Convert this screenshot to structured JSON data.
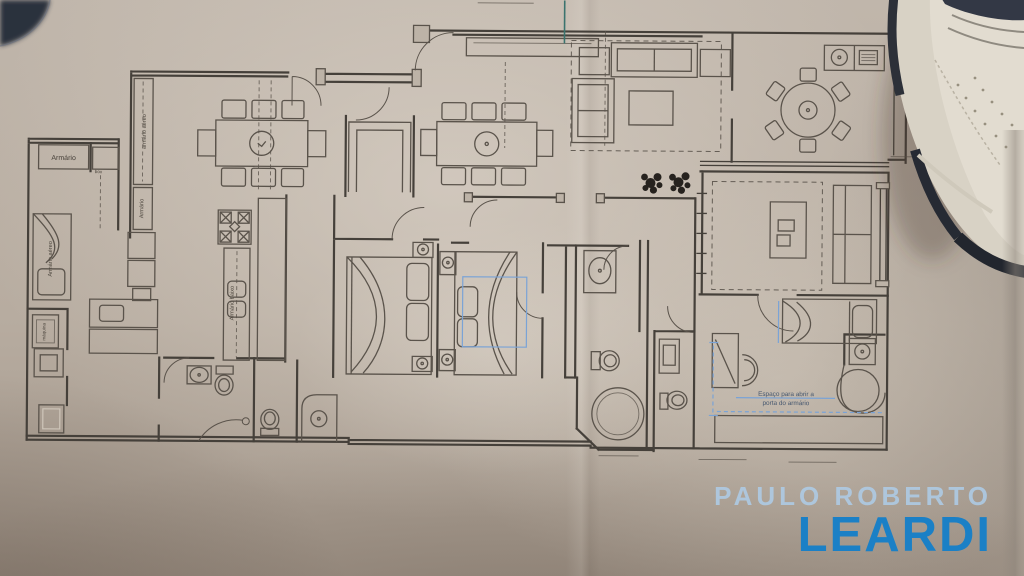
{
  "floorplan": {
    "labels": {
      "closet_top": "Armário",
      "closet_top_small": "box",
      "kitchen_upper_cabinet": "armário aéreo",
      "kitchen_cabinet": "Armário",
      "kitchen_low_cabinet": "Armário baixo",
      "maid_room_cabinet": "Armário aéreo",
      "washing_machine": "máquina",
      "closet_note_line1": "Espaço para abrir a",
      "closet_note_line2": "porta do armário"
    }
  },
  "watermark": {
    "line1": "PAULO ROBERTO",
    "line2": "LEARDI"
  },
  "theme": {
    "paper": "#b7aca0",
    "ink": "#45403a",
    "ink-soft": "#5a534b",
    "blue-note": "#7aa3d6",
    "teal-mark": "#3a736e",
    "wm-light": "#aecde9",
    "wm-blue": "#1b80c6"
  }
}
